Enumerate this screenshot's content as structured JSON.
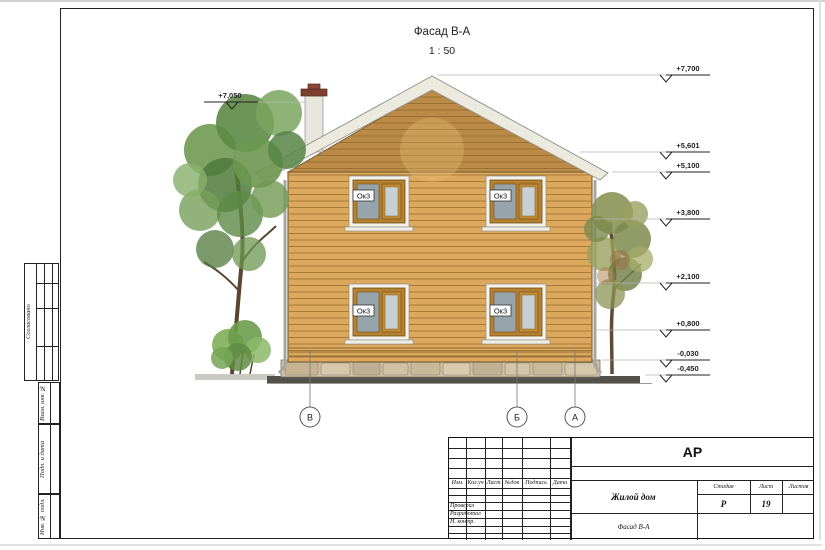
{
  "sheet": {
    "title": "Фасад В-А",
    "scale": "1 : 50"
  },
  "drawing": {
    "window_label": "Ок3",
    "axes": [
      "В",
      "Б",
      "А"
    ],
    "elevations_right": [
      {
        "label": "+7,700"
      },
      {
        "label": "+5,601"
      },
      {
        "label": "+5,100"
      },
      {
        "label": "+3,800"
      },
      {
        "label": "+2,100"
      },
      {
        "label": "+0,800"
      },
      {
        "label": "-0,030"
      },
      {
        "label": "-0,450"
      }
    ],
    "elevation_left": {
      "label": "+7,050"
    }
  },
  "margin": {
    "approved": "Согласовано",
    "substitute_inv": "Взам. инв. №",
    "sign_date": "Подп. и дата",
    "inv_original": "Инв. № подл."
  },
  "title_block": {
    "code": "АР",
    "header_cols": [
      "Изм.",
      "Кол.уч",
      "Лист",
      "№док",
      "Подпись",
      "Дата"
    ],
    "role_rows": [
      "Проверил",
      "Разработал",
      "Н. контр."
    ],
    "project": "Жилой дом",
    "drawing_name": "Фасад В-А",
    "stage_label": "Стадия",
    "sheet_label": "Лист",
    "sheets_label": "Листов",
    "stage": "Р",
    "sheet_no": "19"
  }
}
